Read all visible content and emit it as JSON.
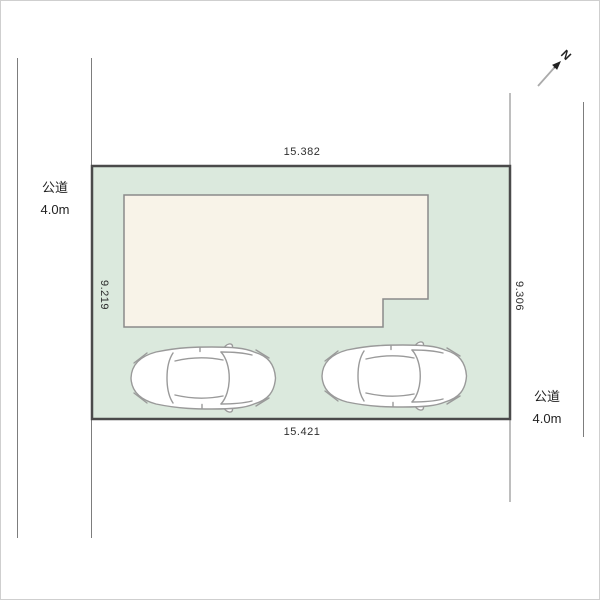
{
  "plan": {
    "north": {
      "label": "N"
    },
    "plot": {
      "dim_top": "15.382",
      "dim_bottom": "15.421",
      "dim_left": "9.219",
      "dim_right": "9.306"
    },
    "roads": {
      "left": {
        "name": "公道",
        "width": "4.0m"
      },
      "right": {
        "name": "公道",
        "width": "4.0m"
      }
    },
    "objects": {
      "building": "building-footprint",
      "car_count": 2
    },
    "colors": {
      "plot_fill": "#dbe9dd",
      "plot_border": "#4a4a4a",
      "building_fill": "#f8f3e8",
      "building_border": "#8a8a8a",
      "road_line": "#7d7d7d",
      "car_outline": "#9a9a9a",
      "label_text": "#2e2e2e"
    }
  }
}
